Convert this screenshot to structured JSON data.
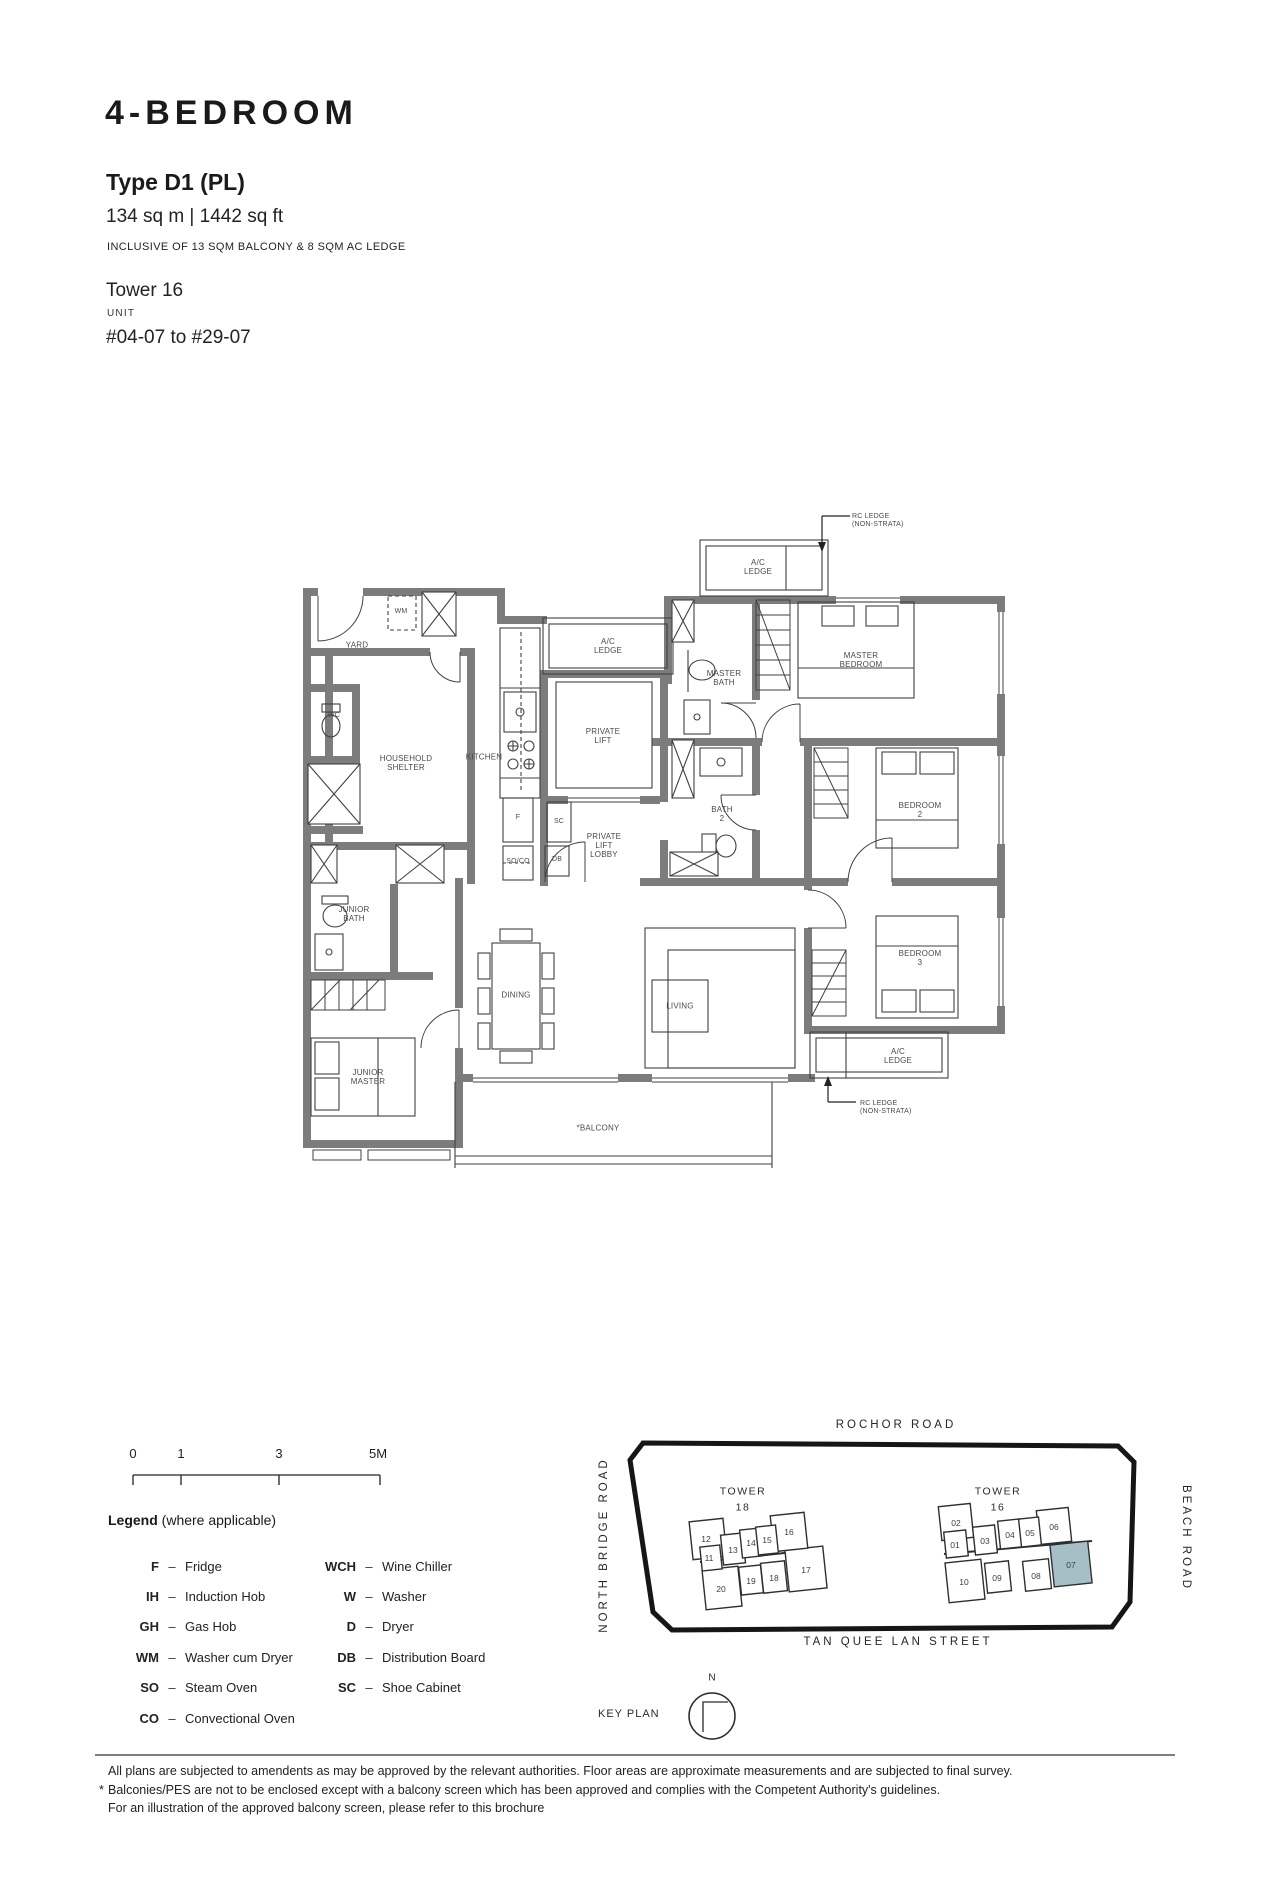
{
  "header": {
    "title": "4-BEDROOM",
    "type": "Type D1 (PL)",
    "area": "134 sq m | 1442 sq ft",
    "inclusive": "INCLUSIVE OF 13 SQM BALCONY & 8 SQM AC LEDGE",
    "tower": "Tower 16",
    "unit_label": "UNIT",
    "unit_range": "#04-07 to #29-07"
  },
  "floorplan": {
    "labels": {
      "rc_ledge_top": "RC LEDGE\n(NON-STRATA)",
      "ac_ledge": "A/C\nLEDGE",
      "yard": "YARD",
      "wm": "WM",
      "wc": "WC",
      "household_shelter": "HOUSEHOLD\nSHELTER",
      "kitchen": "KITCHEN",
      "private_lift": "PRIVATE\nLIFT",
      "master_bath": "MASTER\nBATH",
      "master_bedroom": "MASTER\nBEDROOM",
      "bath_2": "BATH\n2",
      "bedroom_2": "BEDROOM\n2",
      "bedroom_3": "BEDROOM\n3",
      "private_lift_lobby": "PRIVATE\nLIFT\nLOBBY",
      "f": "F",
      "sc": "SC",
      "so_co": "SO/CO",
      "db": "DB",
      "junior_bath": "JUNIOR\nBATH",
      "dining": "DINING",
      "living": "LIVING",
      "junior_master": "JUNIOR\nMASTER",
      "balcony": "*BALCONY",
      "rc_ledge_bottom": "RC LEDGE\n(NON-STRATA)"
    }
  },
  "scalebar": {
    "ticks": [
      "0",
      "1",
      "3",
      "5M"
    ]
  },
  "legend": {
    "title": "Legend",
    "subtitle": "(where applicable)",
    "separator": "–",
    "items": [
      {
        "abbr": "F",
        "name": "Fridge"
      },
      {
        "abbr": "IH",
        "name": "Induction Hob"
      },
      {
        "abbr": "GH",
        "name": "Gas Hob"
      },
      {
        "abbr": "WM",
        "name": "Washer cum Dryer"
      },
      {
        "abbr": "SO",
        "name": "Steam Oven"
      },
      {
        "abbr": "CO",
        "name": "Convectional Oven"
      },
      {
        "abbr": "WCH",
        "name": "Wine Chiller"
      },
      {
        "abbr": "W",
        "name": "Washer"
      },
      {
        "abbr": "D",
        "name": "Dryer"
      },
      {
        "abbr": "DB",
        "name": "Distribution Board"
      },
      {
        "abbr": "SC",
        "name": "Shoe Cabinet"
      }
    ]
  },
  "keyplan": {
    "roads": {
      "top": "ROCHOR ROAD",
      "left": "NORTH BRIDGE ROAD",
      "right": "BEACH ROAD",
      "bottom": "TAN QUEE LAN STREET"
    },
    "towers": [
      {
        "label": "TOWER\n18",
        "units": [
          "12",
          "13",
          "14",
          "15",
          "16",
          "11",
          "20",
          "19",
          "18",
          "17"
        ]
      },
      {
        "label": "TOWER\n16",
        "units": [
          "02",
          "01",
          "03",
          "04",
          "05",
          "06",
          "10",
          "09",
          "08",
          "07"
        ]
      }
    ],
    "highlight_unit": "07",
    "highlight_color": "#a6bfc7",
    "key_plan_label": "KEY PLAN",
    "north": "N"
  },
  "footer": {
    "asterisk": "*",
    "line1": "All plans are subjected to amendents as may be approved by the relevant authorities. Floor areas are approximate measurements and are subjected to final survey.",
    "line2": "Balconies/PES are not to be enclosed except with a balcony screen which has been approved and complies with the Competent Authority's guidelines.",
    "line3": "For an illustration of the approved balcony screen, please refer to this brochure"
  }
}
